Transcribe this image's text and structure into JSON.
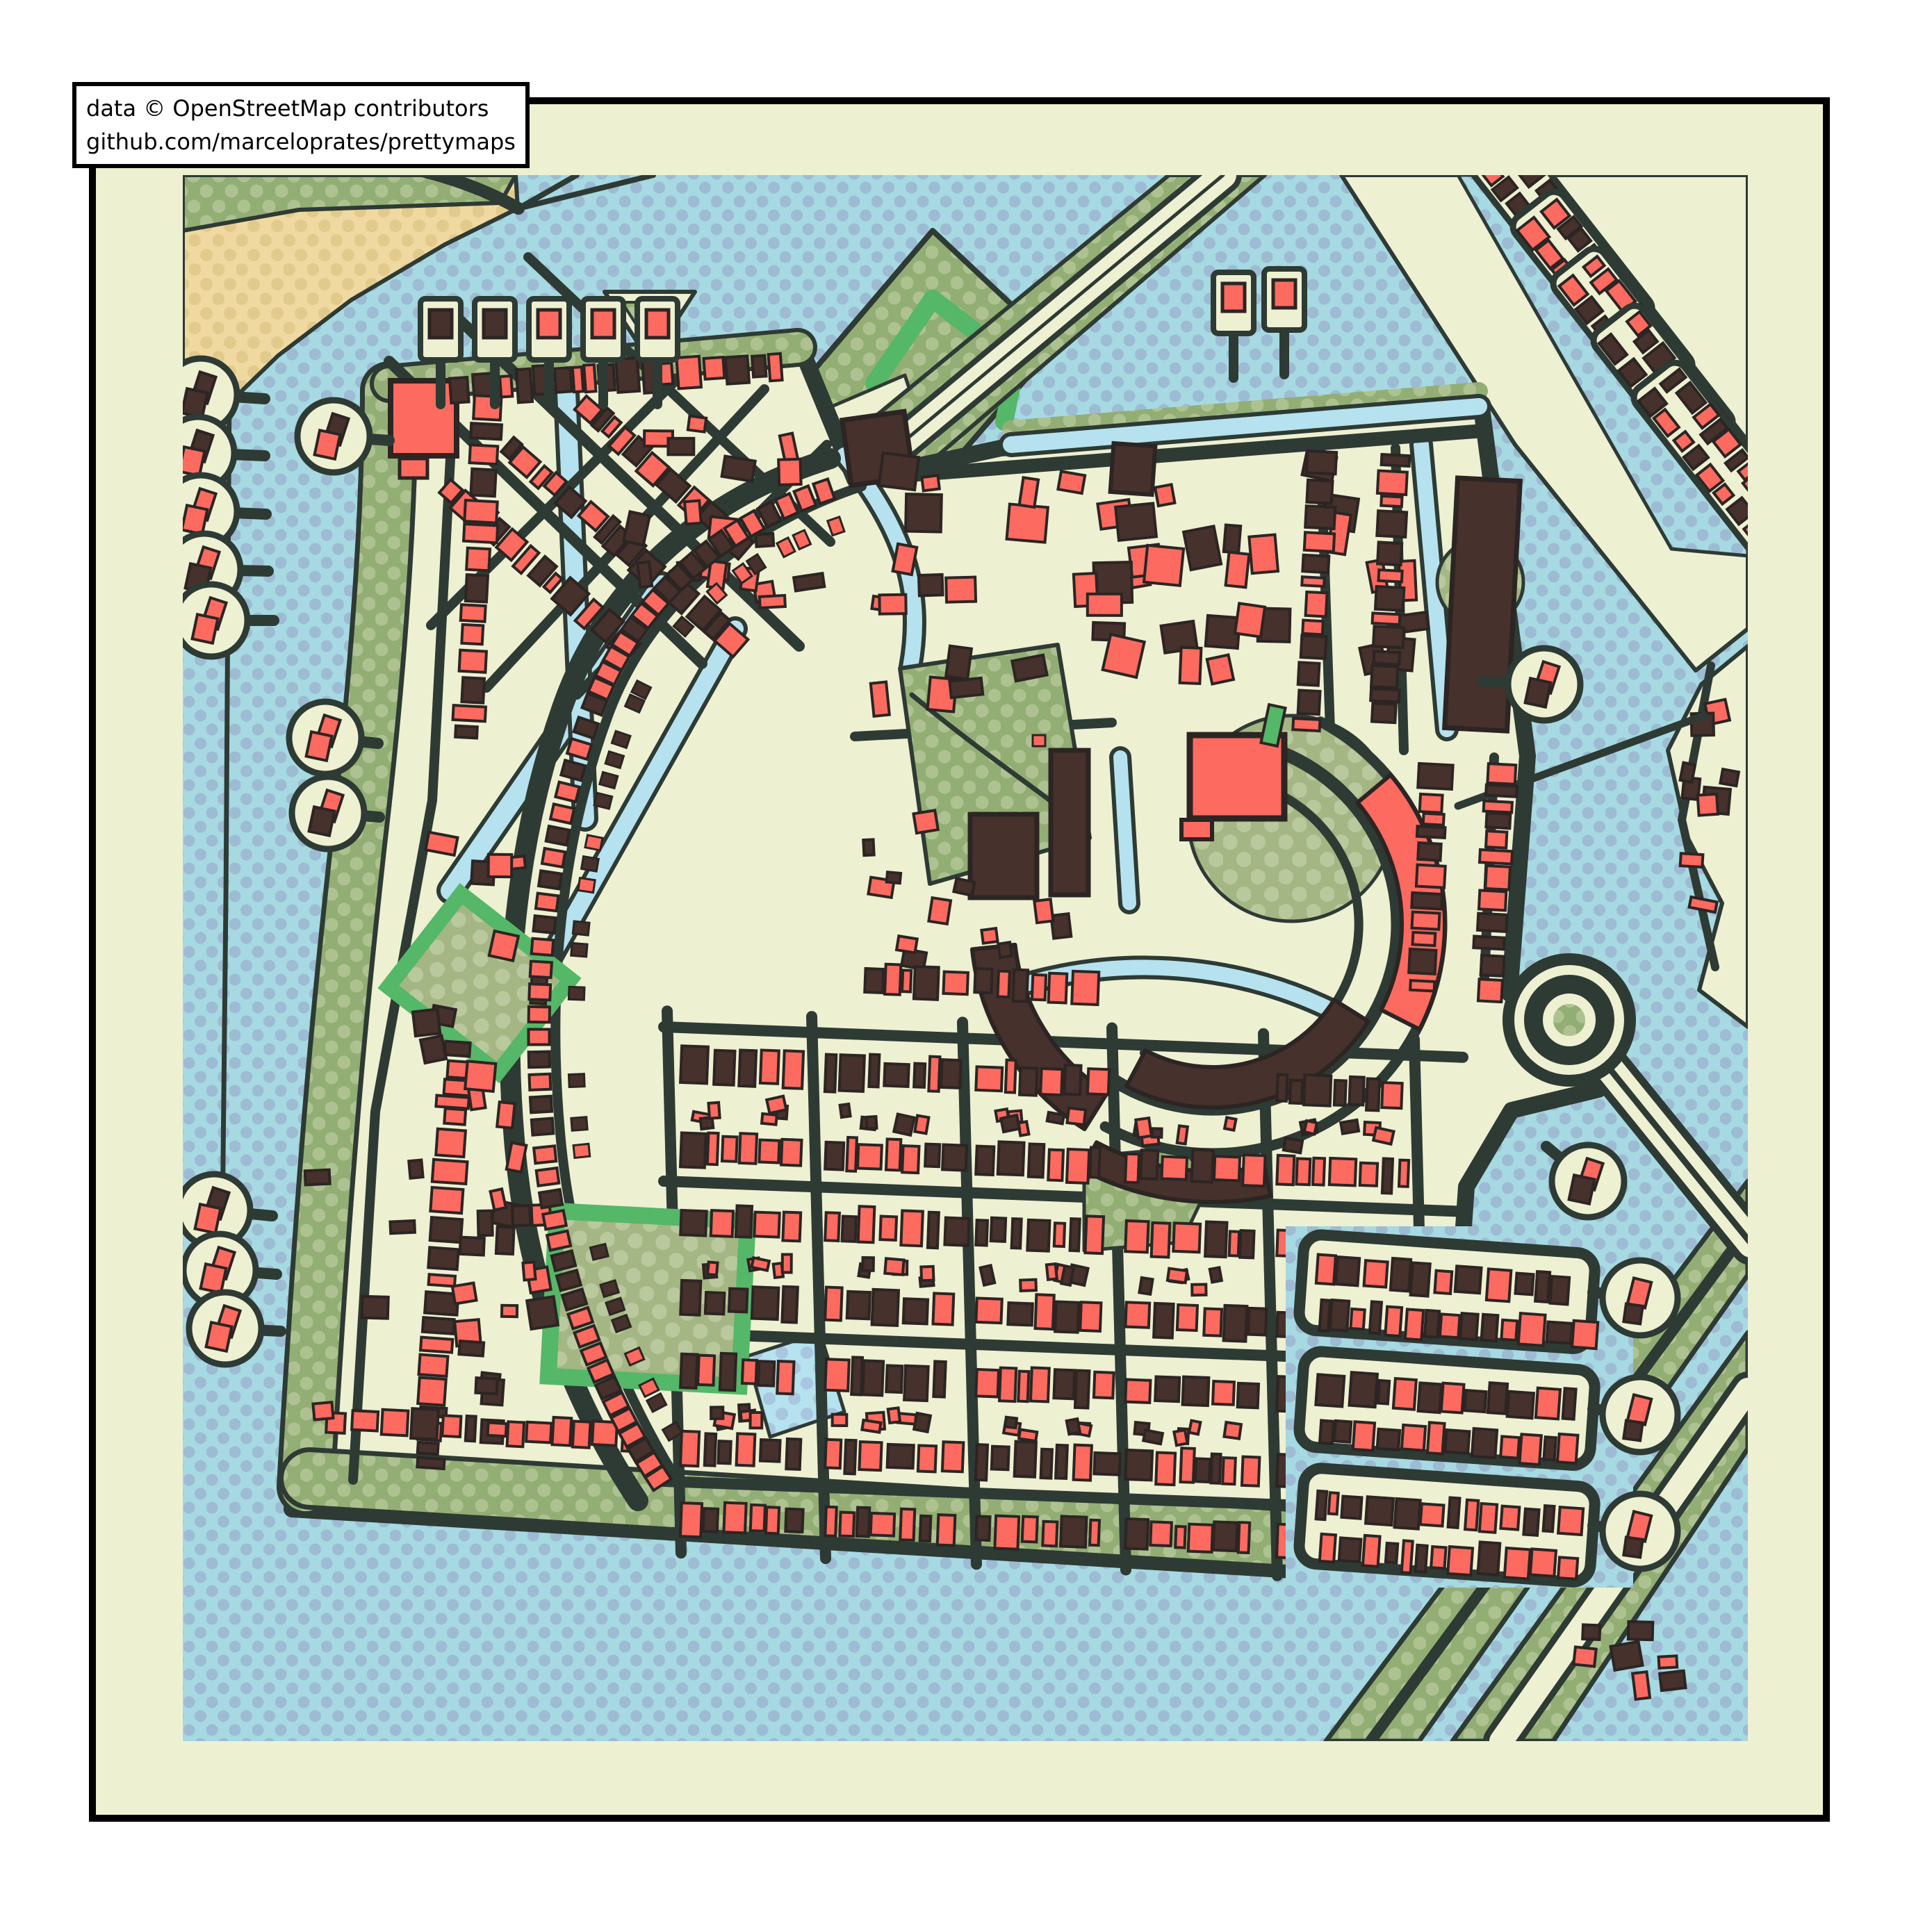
{
  "attribution": {
    "line1": "data © OpenStreetMap contributors",
    "line2": "github.com/marceloprates/prettymaps"
  },
  "palette": {
    "page_background": "#ffffff",
    "figure_background": "#eef0d2",
    "frame_border": "#000000",
    "water": "#a6d9e2",
    "water_dot": "#9dbbd3",
    "land": "#eef0d2",
    "green": "#93ae74",
    "green_dot": "#aec291",
    "park": "#a4b683",
    "park_dot": "#bac89e",
    "bright_green": "#55b768",
    "sand": "#f0d9a0",
    "sand_dot": "#e2ca8d",
    "street": "#2e3a34",
    "building_red": "#fc6a60",
    "building_dark": "#46312c",
    "building_outline": "#2c2523",
    "canal": "#b5e2ee",
    "canal_dot": "#a9c6e0",
    "attribution_background": "#ffffff",
    "attribution_text": "#000000"
  }
}
